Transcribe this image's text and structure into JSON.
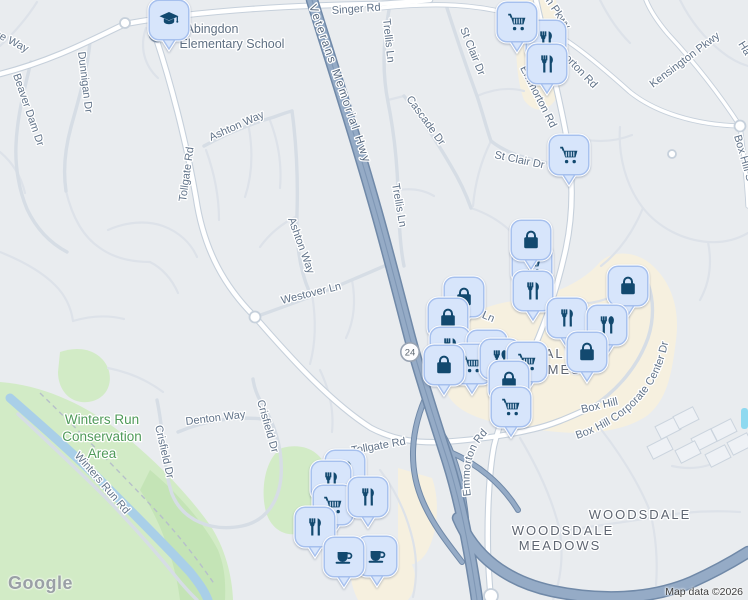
{
  "branding": {
    "logo": "Google"
  },
  "attribution": {
    "text": "Map data ©2026"
  },
  "route_shield": {
    "number": "24",
    "x": 410,
    "y": 352
  },
  "colors": {
    "background": "#e9ecef",
    "park_green": "#d2ebc6",
    "park_green_dark": "#c4e4b6",
    "water_blue": "#a9cfe8",
    "pool_blue": "#8ed9f0",
    "commercial_tan": "#f6f0df",
    "road_white": "#ffffff",
    "road_casing": "#c6d0db",
    "minor_road": "#dde2e9",
    "highway_fill": "#95abc6",
    "highway_casing": "#7089a8",
    "pin_fill": "#d7e5fb",
    "pin_border": "#a6c0ee",
    "pin_icon": "#12496f",
    "road_label": "#617389",
    "area_label": "#5e6571",
    "park_label": "#4f9a59",
    "school_label": "#5f7083",
    "google_logo_gray": "#9aa0a6"
  },
  "labels": [
    {
      "n": "singer-rd",
      "t": "Singer Rd",
      "x": 332,
      "y": 14,
      "r": -4,
      "c": "lbl-road",
      "fs": 11.5
    },
    {
      "n": "trellis-ln-1",
      "t": "Trellis Ln",
      "x": 383,
      "y": 19,
      "r": 84,
      "c": "lbl-road"
    },
    {
      "n": "trellis-ln-2",
      "t": "Trellis Ln",
      "x": 392,
      "y": 184,
      "r": 80,
      "c": "lbl-road"
    },
    {
      "n": "cascade-dr",
      "t": "Cascade Dr",
      "x": 406,
      "y": 99,
      "r": 54,
      "c": "lbl-road"
    },
    {
      "n": "st-clair-dr-1",
      "t": "St Clair Dr",
      "x": 460,
      "y": 29,
      "r": 68,
      "c": "lbl-road"
    },
    {
      "n": "st-clair-dr-2",
      "t": "St Clair Dr",
      "x": 494,
      "y": 158,
      "r": 12,
      "c": "lbl-road"
    },
    {
      "n": "kensington-pkwy",
      "t": "Kensington Pkwy",
      "x": 653,
      "y": 88,
      "r": -37,
      "c": "lbl-road"
    },
    {
      "n": "kensington-pkwy-2",
      "t": "Kensington Pkwy",
      "x": 518,
      "y": -40,
      "r": 56,
      "c": "lbl-road"
    },
    {
      "n": "ha-fragment",
      "t": "Ha",
      "x": 738,
      "y": 44,
      "r": 58,
      "c": "lbl-road"
    },
    {
      "n": "box-hill-s-pkwy",
      "t": "Box Hill S Pkwy",
      "x": 734,
      "y": 136,
      "r": 74,
      "c": "lbl-road"
    },
    {
      "n": "emmorton-rd-1",
      "t": "Emmorton Rd",
      "x": 520,
      "y": 68,
      "r": 63,
      "c": "lbl-road"
    },
    {
      "n": "emmorton-rd-2",
      "t": "Emmorton Rd",
      "x": 546,
      "y": 40,
      "r": 46,
      "c": "lbl-road"
    },
    {
      "n": "tollgate-rd-n",
      "t": "Tollgate Rd",
      "x": 186,
      "y": 202,
      "r": -82,
      "c": "lbl-road"
    },
    {
      "n": "ashton-way-1",
      "t": "Ashton Way",
      "x": 211,
      "y": 141,
      "r": -24,
      "c": "lbl-road"
    },
    {
      "n": "ashton-way-2",
      "t": "Ashton Way",
      "x": 288,
      "y": 219,
      "r": 70,
      "c": "lbl-road"
    },
    {
      "n": "westover-ln",
      "t": "Westover Ln",
      "x": 282,
      "y": 304,
      "r": -14,
      "c": "lbl-road"
    },
    {
      "n": "trellis-ln-3",
      "t": "Trellis Ln",
      "x": 452,
      "y": 305,
      "r": 23,
      "c": "lbl-road"
    },
    {
      "n": "box-hill-frag",
      "t": "Box Hill",
      "x": 582,
      "y": 413,
      "r": -13,
      "c": "lbl-road"
    },
    {
      "n": "tollgate-rd-s",
      "t": "Tollgate Rd",
      "x": 352,
      "y": 454,
      "r": -10,
      "c": "lbl-road",
      "fs": 12
    },
    {
      "n": "denton-way",
      "t": "Denton Way",
      "x": 186,
      "y": 425,
      "r": -7,
      "c": "lbl-road"
    },
    {
      "n": "crisfield-dr-1",
      "t": "Crisfield Dr",
      "x": 155,
      "y": 426,
      "r": 77,
      "c": "lbl-road"
    },
    {
      "n": "crisfield-dr-2",
      "t": "Crisfield Dr",
      "x": 257,
      "y": 401,
      "r": 74,
      "c": "lbl-road"
    },
    {
      "n": "dunnigan-dr",
      "t": "Dunnigan Dr",
      "x": 78,
      "y": 52,
      "r": 83,
      "c": "lbl-road"
    },
    {
      "n": "beaver-dam-dr",
      "t": "Beaver Dam Dr",
      "x": 13,
      "y": 75,
      "r": 71,
      "c": "lbl-road"
    },
    {
      "n": "se-way-fragment",
      "t": "se Way",
      "x": -6,
      "y": 36,
      "r": 27,
      "c": "lbl-road"
    },
    {
      "n": "winters-run-line1",
      "t": "Winters Run",
      "x": 102,
      "y": 424,
      "r": 0,
      "c": "lbl-green",
      "a": "middle"
    },
    {
      "n": "winters-run-line2",
      "t": "Conservation",
      "x": 102,
      "y": 441,
      "r": 0,
      "c": "lbl-green",
      "a": "middle"
    },
    {
      "n": "winters-run-line3",
      "t": "Area",
      "x": 102,
      "y": 458,
      "r": 0,
      "c": "lbl-green",
      "a": "middle"
    },
    {
      "n": "woodsdale",
      "t": "WOODSDALE",
      "x": 640,
      "y": 519,
      "r": 0,
      "c": "lbl-area",
      "a": "middle",
      "fs": 13.5,
      "ls": 3
    },
    {
      "n": "woodsdale-meadows-line1",
      "t": "WOODSDALE",
      "x": 563,
      "y": 535,
      "r": 0,
      "c": "lbl-area",
      "a": "middle"
    },
    {
      "n": "woodsdale-meadows-line2",
      "t": "MEADOWS",
      "x": 560,
      "y": 550,
      "r": 0,
      "c": "lbl-area",
      "a": "middle"
    },
    {
      "n": "woodsdale-homes-line1",
      "t": "WOODSDALE",
      "x": 524,
      "y": 358,
      "r": 0,
      "c": "lbl-area",
      "a": "middle",
      "fs": 12.5
    },
    {
      "n": "woodsdale-homes-line2",
      "t": "HOMES",
      "x": 553,
      "y": 374,
      "r": 0,
      "c": "lbl-area",
      "a": "middle",
      "fs": 12.5
    },
    {
      "n": "school-name-line1",
      "t": "Abingdon",
      "x": 212,
      "y": 33,
      "r": 0,
      "c": "lbl-school",
      "a": "middle"
    },
    {
      "n": "school-name-line2",
      "t": "Elementary School",
      "x": 232,
      "y": 48,
      "r": 0,
      "c": "lbl-school",
      "a": "middle"
    }
  ],
  "curved_labels": [
    {
      "n": "veterans-memorial-hwy",
      "t": "Veterans Memorial Hwy",
      "d": "M 309,6 C 338,88 367,170 393,252",
      "c": "lbl-hwy"
    },
    {
      "n": "box-hill-corporate-center-dr",
      "t": "Box Hill Corporate Center Dr",
      "d": "M 577,439 C 652,414 679,357 668,288",
      "c": "lbl-road",
      "fs": 10.5
    },
    {
      "n": "emmorton-rd-3",
      "t": "Emmorton Rd",
      "d": "M 471,496 C 465,454 479,432 518,413",
      "c": "lbl-road"
    },
    {
      "n": "winters-run-rd",
      "t": "Winters Run Rd",
      "d": "M 74,456 C 96,480 114,502 136,527",
      "c": "lbl-road"
    }
  ],
  "pins": [
    {
      "t": "restaurant",
      "x": 546,
      "y": 40
    },
    {
      "t": "cart",
      "x": 517,
      "y": 22
    },
    {
      "t": "restaurant",
      "x": 547,
      "y": 64
    },
    {
      "t": "cart",
      "x": 569,
      "y": 155
    },
    {
      "t": "cart",
      "x": 532,
      "y": 264
    },
    {
      "t": "bag",
      "x": 531,
      "y": 240
    },
    {
      "t": "restaurant",
      "x": 533,
      "y": 291
    },
    {
      "t": "bag",
      "x": 464,
      "y": 297
    },
    {
      "t": "bag",
      "x": 448,
      "y": 318
    },
    {
      "t": "bag",
      "x": 628,
      "y": 286
    },
    {
      "t": "restaurant",
      "x": 567,
      "y": 318
    },
    {
      "t": "restaurant-spoon",
      "x": 607,
      "y": 325
    },
    {
      "t": "restaurant",
      "x": 450,
      "y": 347
    },
    {
      "t": "restaurant",
      "x": 487,
      "y": 350
    },
    {
      "t": "bag",
      "x": 587,
      "y": 352
    },
    {
      "t": "cart",
      "x": 472,
      "y": 364
    },
    {
      "t": "restaurant-spoon",
      "x": 500,
      "y": 359
    },
    {
      "t": "cart",
      "x": 527,
      "y": 362
    },
    {
      "t": "bag",
      "x": 444,
      "y": 365
    },
    {
      "t": "bag",
      "x": 509,
      "y": 381
    },
    {
      "t": "cart",
      "x": 511,
      "y": 407
    },
    {
      "t": "restaurant",
      "x": 345,
      "y": 470
    },
    {
      "t": "restaurant",
      "x": 331,
      "y": 481
    },
    {
      "t": "cart",
      "x": 333,
      "y": 505
    },
    {
      "t": "restaurant",
      "x": 368,
      "y": 497
    },
    {
      "t": "restaurant",
      "x": 315,
      "y": 527
    },
    {
      "t": "coffee",
      "x": 377,
      "y": 556
    },
    {
      "t": "coffee",
      "x": 344,
      "y": 557
    },
    {
      "t": "school",
      "x": 169,
      "y": 20
    }
  ]
}
